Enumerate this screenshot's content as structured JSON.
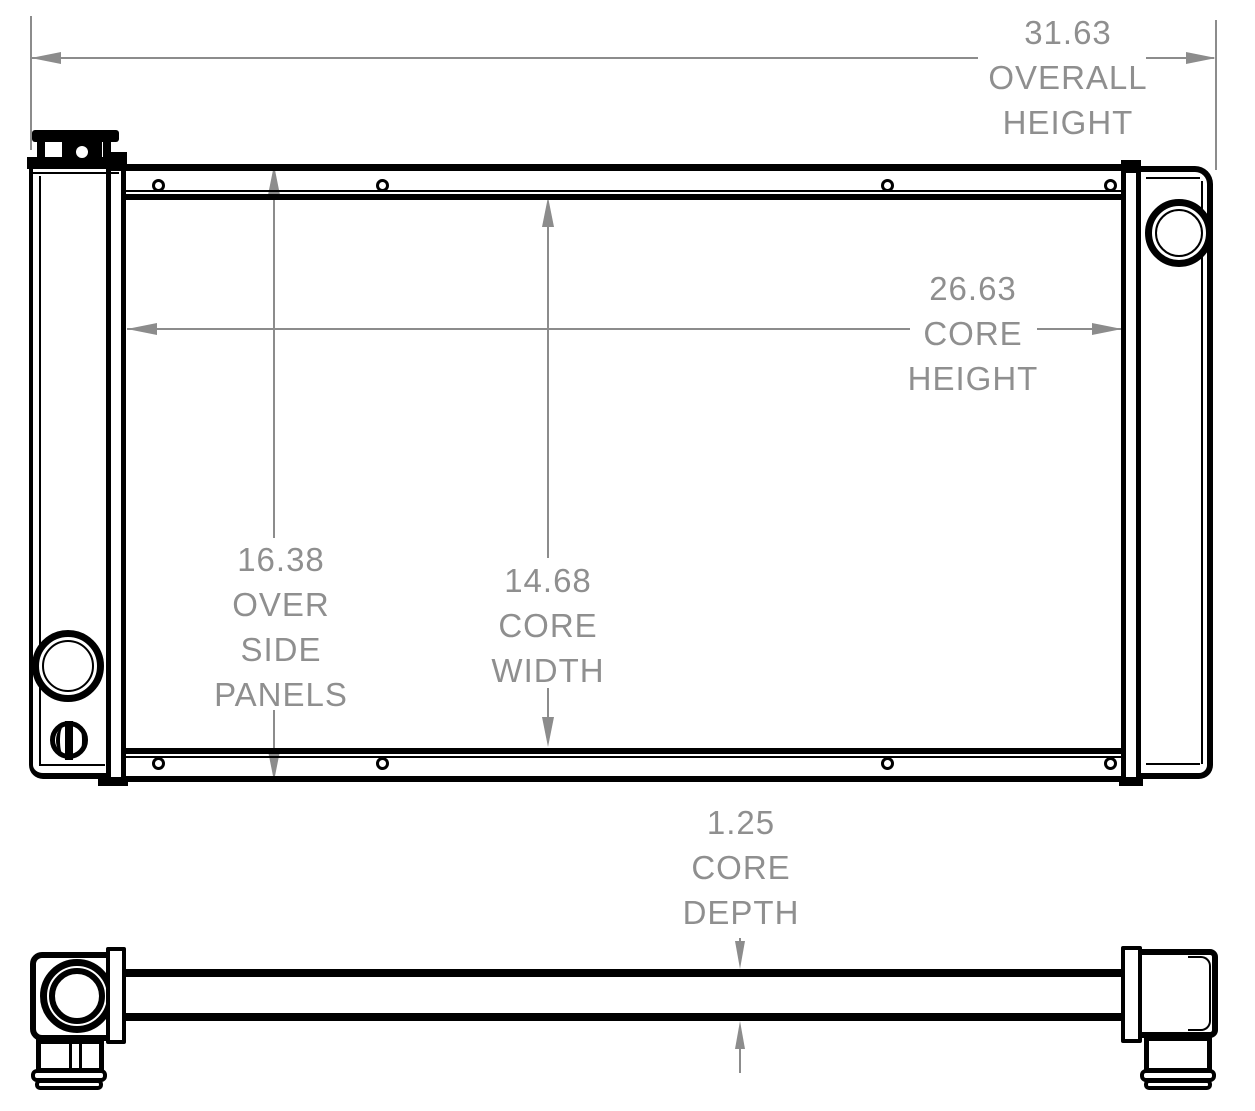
{
  "dimensions": {
    "overall_height": {
      "value": "31.63",
      "label1": "OVERALL",
      "label2": "HEIGHT"
    },
    "core_height": {
      "value": "26.63",
      "label1": "CORE",
      "label2": "HEIGHT"
    },
    "over_side_panels": {
      "value": "16.38",
      "label1": "OVER",
      "label2": "SIDE",
      "label3": "PANELS"
    },
    "core_width": {
      "value": "14.68",
      "label1": "CORE",
      "label2": "WIDTH"
    },
    "core_depth": {
      "value": "1.25",
      "label1": "CORE",
      "label2": "DEPTH"
    }
  },
  "colors": {
    "line": "#000000",
    "dimension_gray": "#8c8c8c",
    "text_gray": "#8f8f8f",
    "background": "#ffffff"
  }
}
